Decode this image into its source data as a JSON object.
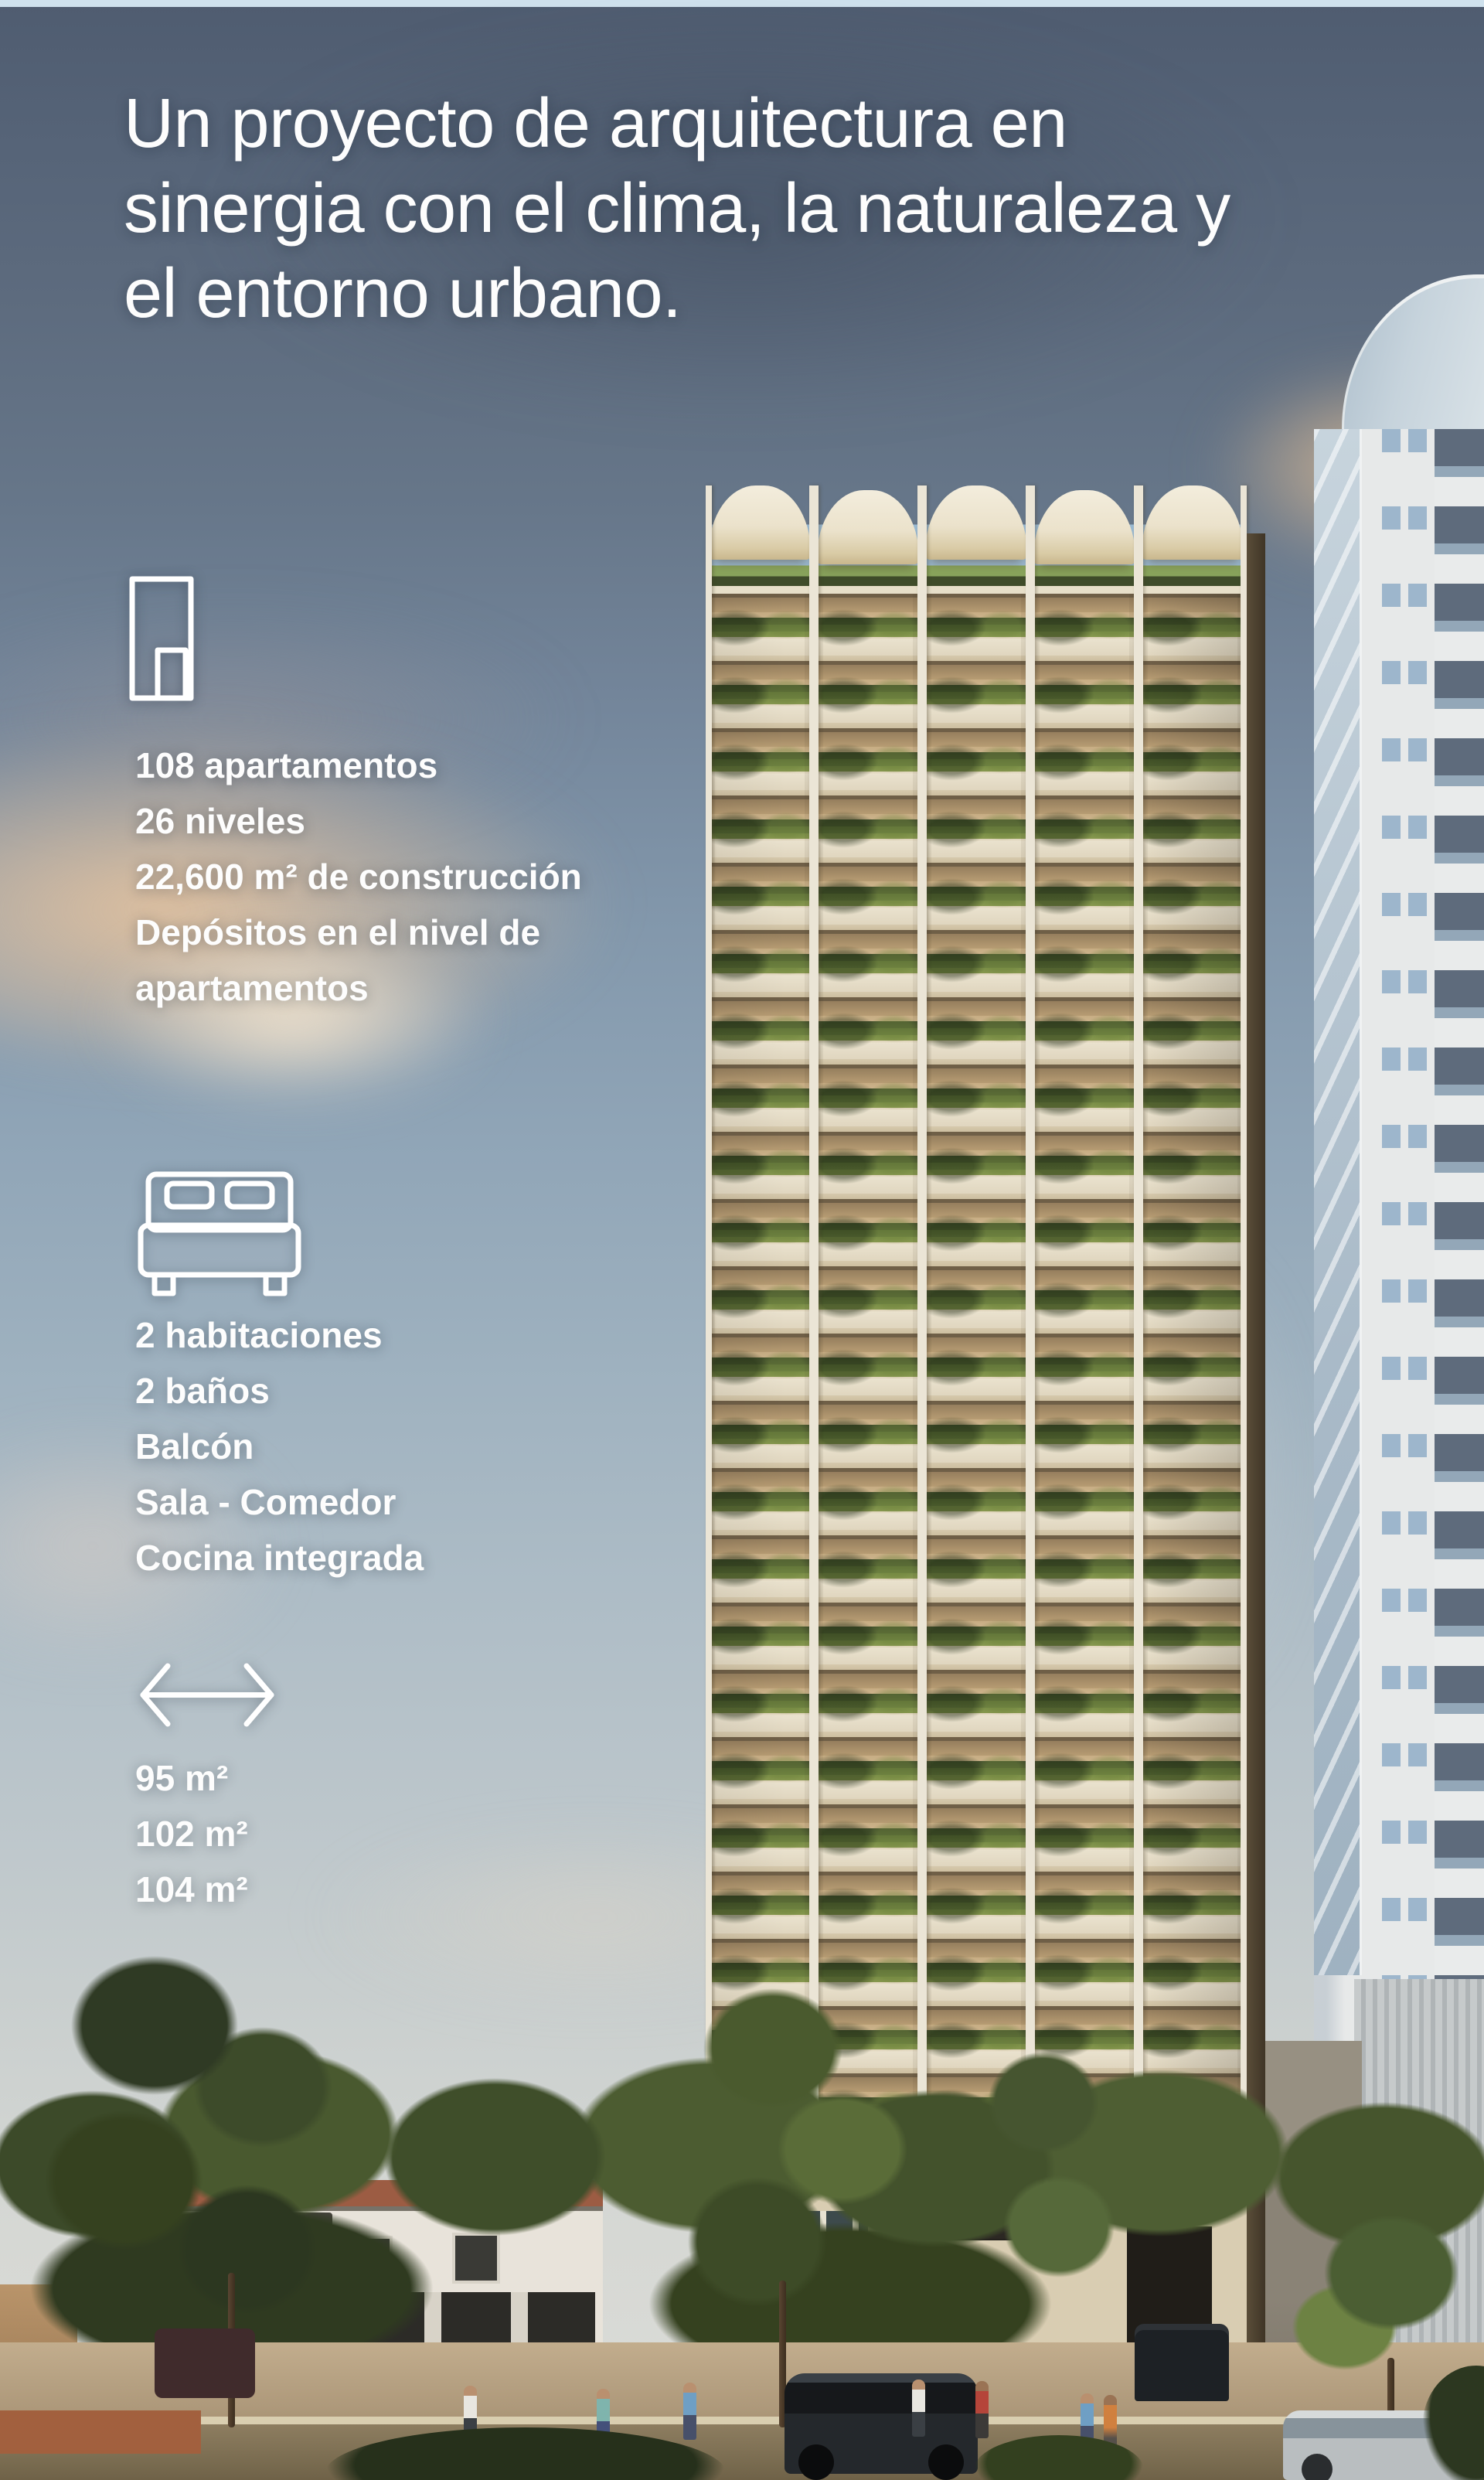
{
  "hero": {
    "lines": [
      "Un proyecto de arquitectura en",
      "sinergia con el clima, la naturaleza y",
      "el entorno urbano."
    ]
  },
  "sections": [
    {
      "icon": "building-icon",
      "lines": [
        "108 apartamentos",
        "26 niveles",
        "22,600 m² de construcción",
        "Depósitos en el nivel de\napartamentos"
      ]
    },
    {
      "icon": "bed-icon",
      "lines": [
        "2 habitaciones",
        "2 baños",
        "Balcón",
        "Sala - Comedor",
        "Cocina integrada"
      ]
    },
    {
      "icon": "width-arrow-icon",
      "lines": [
        "95 m²",
        "102 m²",
        "104 m²"
      ]
    }
  ],
  "palette": {
    "text": "#fdfdfd",
    "sky_top": "#4f5c70",
    "cloud_peach": "#e8c49e",
    "tower_cream": "#ece4d1",
    "foliage_green": "#4e5d32",
    "white_tower": "#e7e9e9",
    "road_tan": "#8d7d60"
  }
}
